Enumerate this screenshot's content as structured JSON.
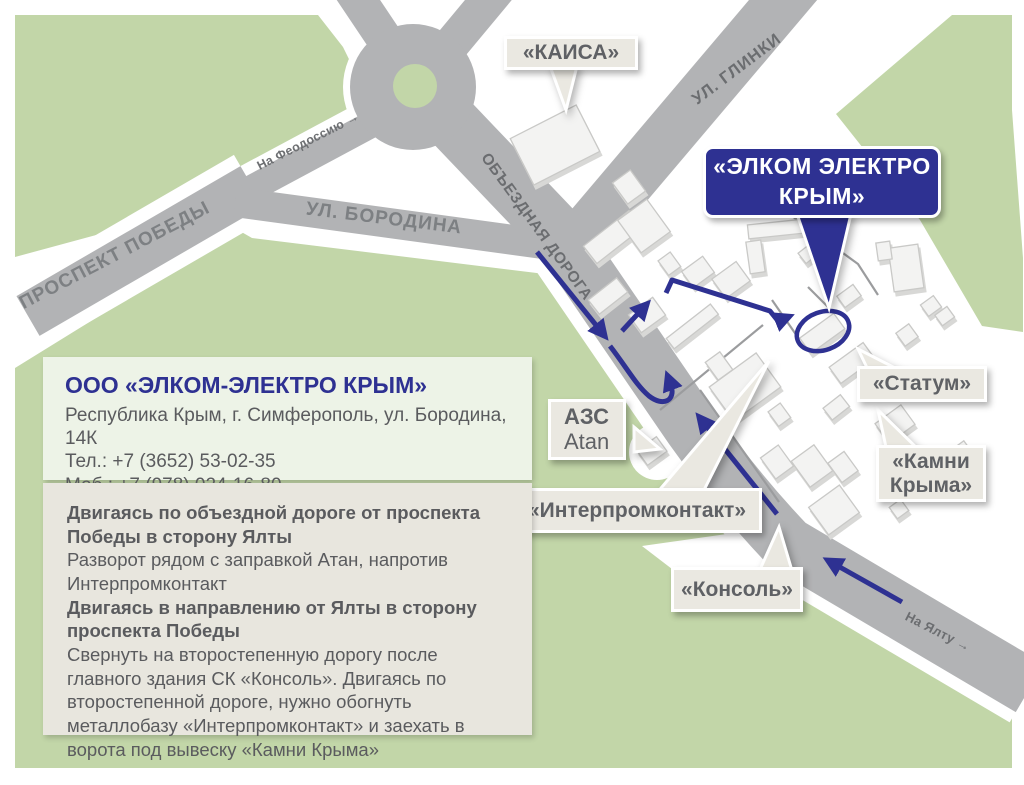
{
  "map": {
    "streets": {
      "pobedy": "ПРОСПЕКТ ПОБЕДЫ",
      "feodosiya": "На Феодоссию →",
      "borodina": "УЛ. БОРОДИНА",
      "obyezdnaya": "ОБЪЕЗДНАЯ ДОРОГА",
      "glinki": "УЛ. ГЛИНКИ",
      "yalta": "На Ялту →"
    },
    "callouts": {
      "kaisa": "«КАИСА»",
      "elkom_line1": "«ЭЛКОМ ЭЛЕКТРО",
      "elkom_line2": "КРЫМ»",
      "statum": "«Статум»",
      "kamni_line1": "«Камни",
      "kamni_line2": "Крыма»",
      "interpromkontakt": "«Интерпромконтакт»",
      "konsol": "«Консоль»",
      "azs_line1": "АЗС",
      "azs_line2": "Atan"
    },
    "colors": {
      "accent_blue": "#2e3192",
      "green_area": "#c2d6a8",
      "road_gray": "#b2b3b5"
    }
  },
  "info_box": {
    "title": "ООО «ЭЛКОМ-ЭЛЕКТРО КРЫМ»",
    "address": "Республика Крым, г. Симферополь, ул. Бородина, 14К",
    "phone": "Тел.: +7 (3652) 53-02-35",
    "mobile": "Моб.: +7 (978) 024-16-80",
    "hours": "Пн-пт: 9.00-18.00"
  },
  "directions_box": {
    "heading1": "Двигаясь по объездной дороге от проспекта Победы в сторону Ялты",
    "text1": "Разворот рядом с заправкой Атан, напротив Интерпромконтакт",
    "heading2": "Двигаясь в направлению от Ялты в сторону проспекта Победы",
    "text2": "Свернуть на второстепенную дорогу после главного здания СК «Консоль». Двигаясь по второстепенной дороге, нужно обогнуть металлобазу «Интерпромконтакт» и заехать в ворота под вывеску «Камни Крыма»"
  }
}
